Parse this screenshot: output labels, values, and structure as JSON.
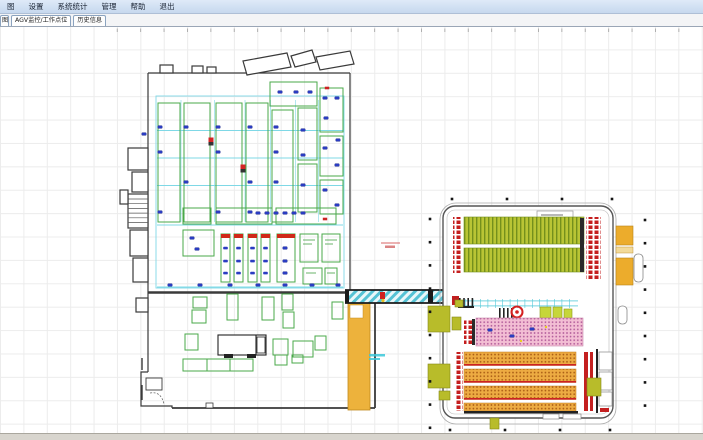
{
  "menu_bar": {
    "items": [
      {
        "label": "图"
      },
      {
        "label": "设置"
      },
      {
        "label": "系统统计"
      },
      {
        "label": "管理"
      },
      {
        "label": "帮助"
      },
      {
        "label": "退出"
      }
    ]
  },
  "tab_bar": {
    "tabs": [
      {
        "label": "图",
        "state": "clipped"
      },
      {
        "label": "AGV监控/工作点位",
        "state": "active"
      },
      {
        "label": "历史信息",
        "state": "normal"
      }
    ]
  },
  "colors": {
    "menubar_bg": "#c6d8ee",
    "canvas_grid": "#ececec",
    "wall": "#3a3a3a",
    "path_cyan": "#7fd8e6",
    "lane_green": "#4aa84a",
    "work_point_blue": "#2a3cc2",
    "alert_red": "#d42424",
    "rack_olive": "#b9c535",
    "rack_pink": "#f3bed4",
    "rack_orange": "#edab42",
    "dock_amber": "#ecac2c",
    "strip_yellow": "#edb23c",
    "corridor_teal": "#55c2d4",
    "statusbar_bg": "#d8d5ce"
  }
}
